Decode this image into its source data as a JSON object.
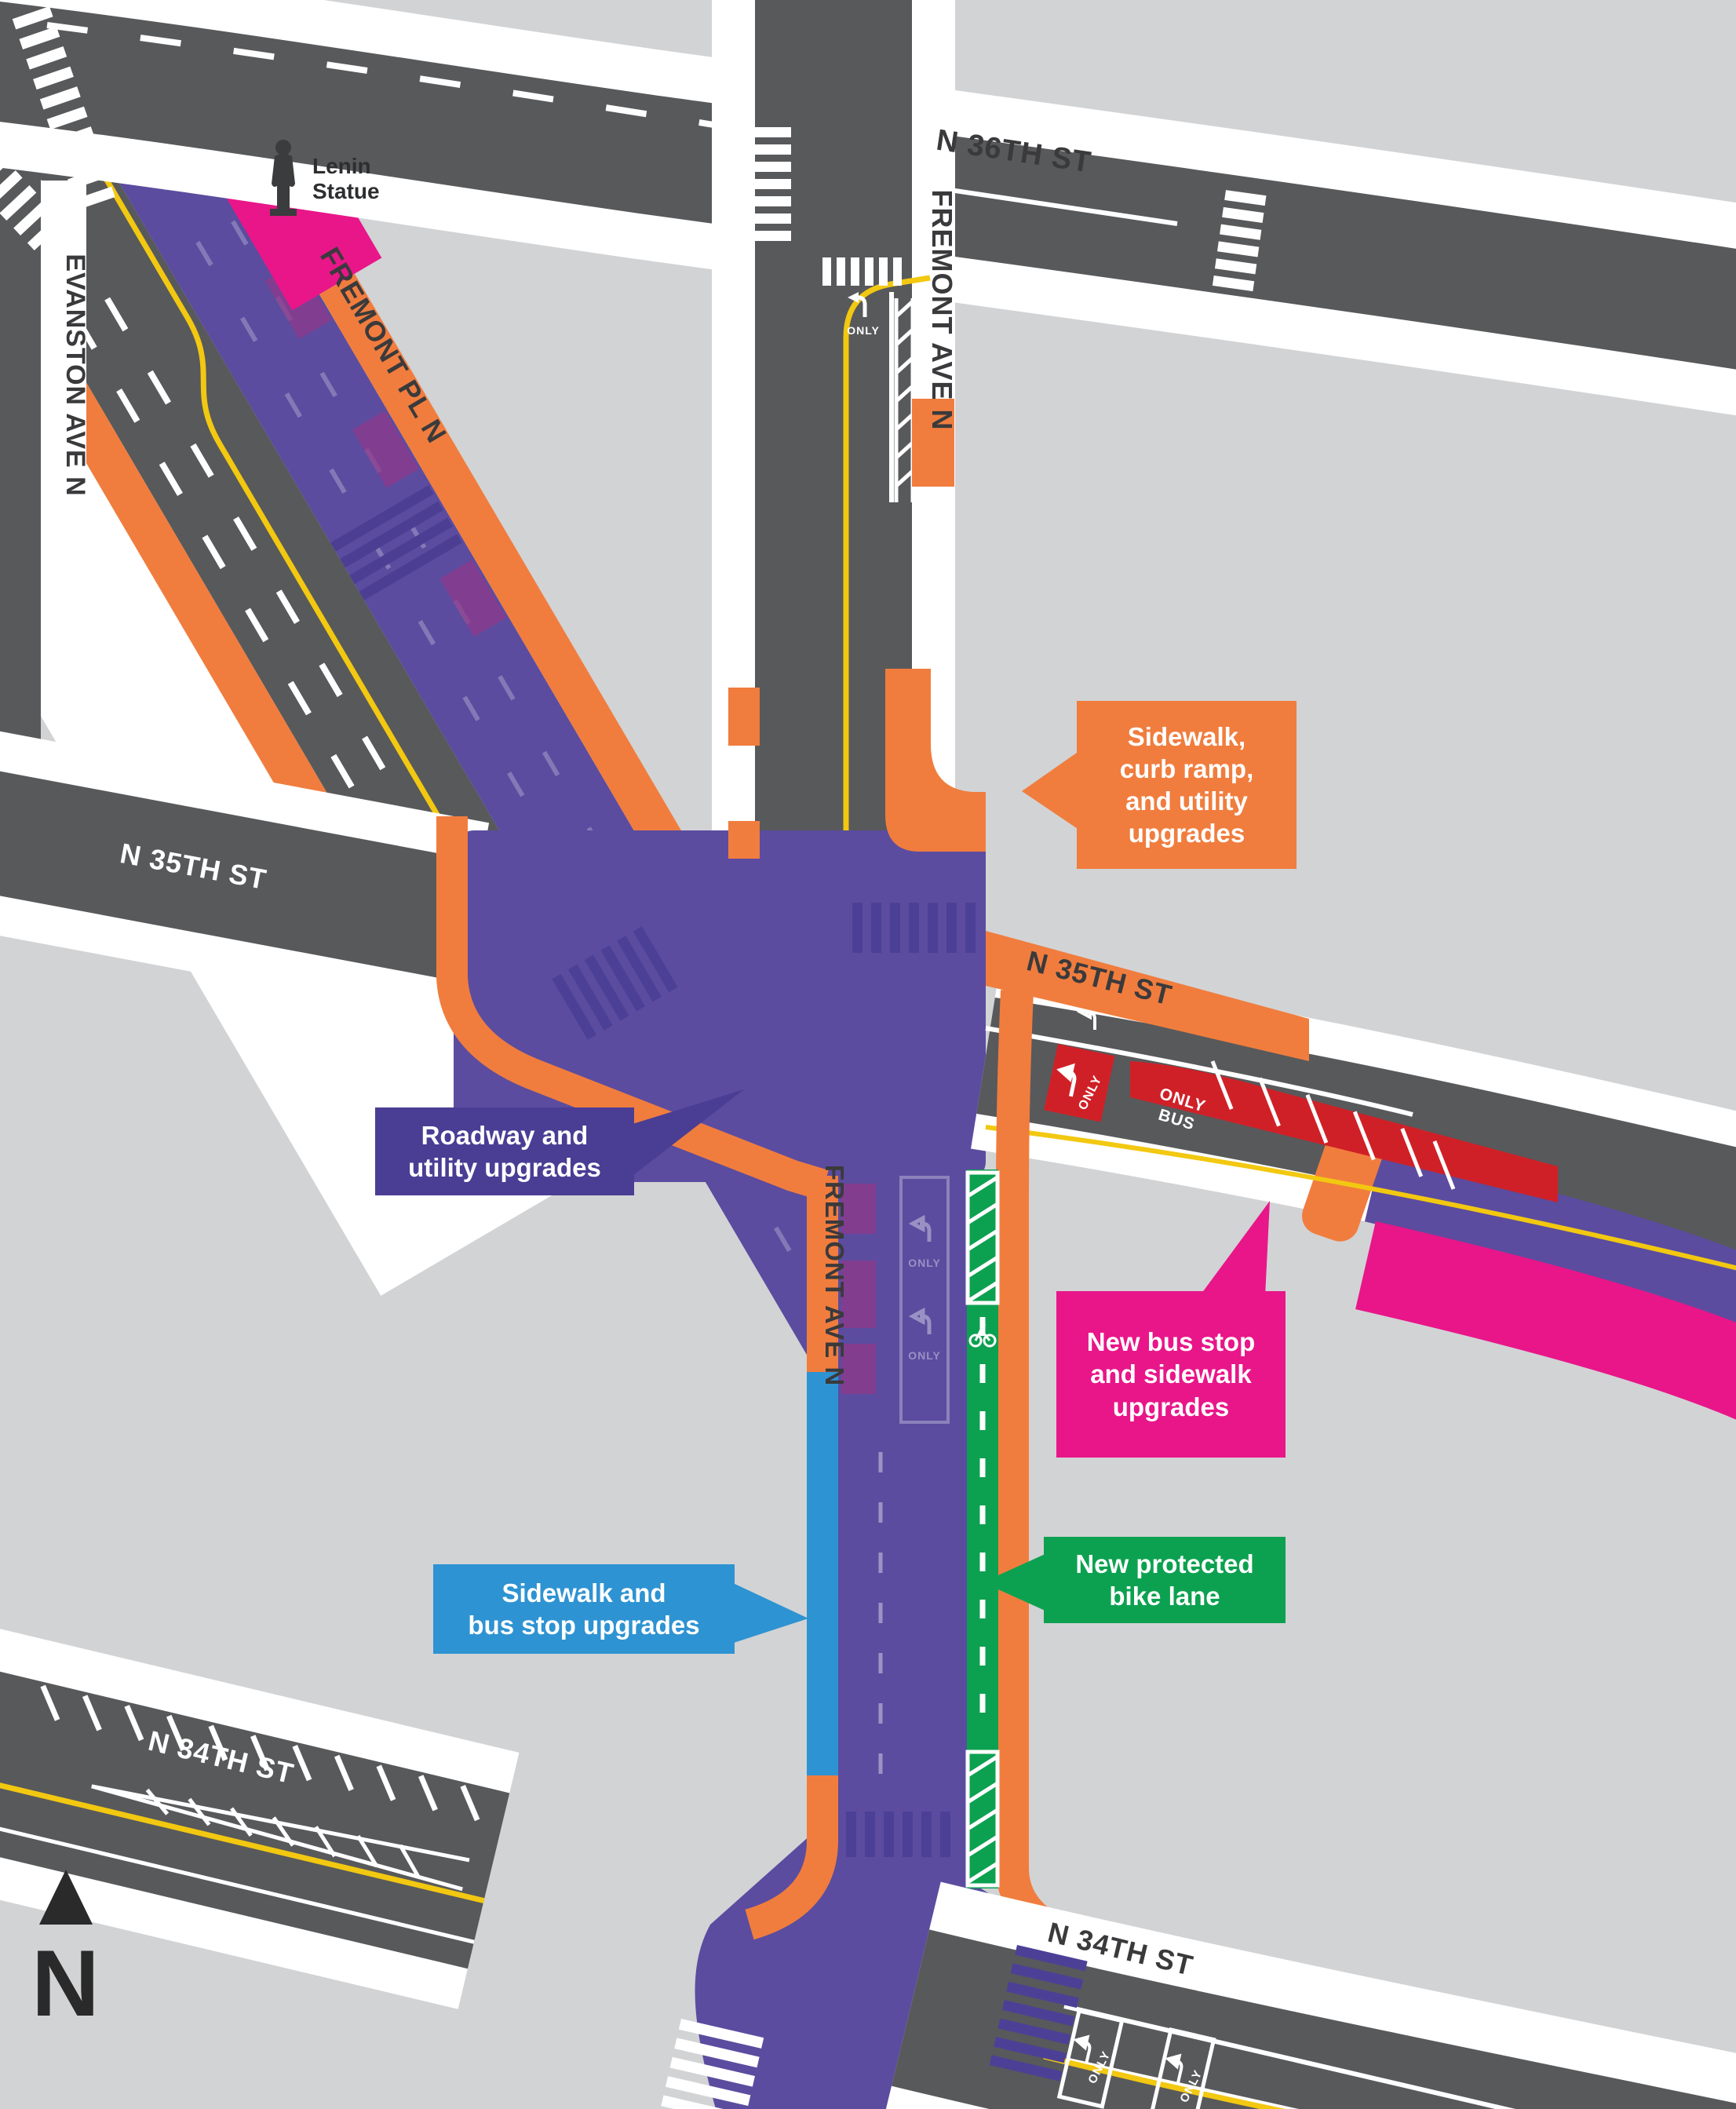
{
  "map": {
    "title": "Fremont paving and multimodal improvements map",
    "street_labels": {
      "n36th": "N 36TH ST",
      "fremont_ave_north": "FREMONT AVE N",
      "fremont_pl": "FREMONT PL N",
      "evanston": "EVANSTON AVE N",
      "n35th_west": "N 35TH ST",
      "n35th_east": "N 35TH ST",
      "fremont_ave_south": "FREMONT AVE N",
      "n34th_west": "N 34TH ST",
      "n34th_east": "N 34TH ST"
    },
    "poi": {
      "lenin_statue": "Lenin\nStatue"
    },
    "north_arrow": {
      "label": "N"
    },
    "road_markings": {
      "bus": "BUS",
      "only": "ONLY"
    },
    "callouts": [
      {
        "id": "sidewalk-curb-ramp-utility",
        "text": "Sidewalk,\ncurb ramp,\nand utility\nupgrades",
        "color": "#F07D3E"
      },
      {
        "id": "roadway-utility",
        "text": "Roadway and\nutility upgrades",
        "color": "#4A3D94"
      },
      {
        "id": "new-bus-stop-sidewalk",
        "text": "New bus stop\nand sidewalk\nupgrades",
        "color": "#E81689"
      },
      {
        "id": "sidewalk-bus-stop",
        "text": "Sidewalk and\nbus stop upgrades",
        "color": "#2E93D2"
      },
      {
        "id": "new-protected-bike-lane",
        "text": "New protected\nbike lane",
        "color": "#0CA150"
      }
    ],
    "colors": {
      "background_block": "#d2d3d5",
      "road": "#58595b",
      "roadway_upgrade_purple": "#5b4c9f",
      "sidewalk_upgrade_orange": "#F07D3E",
      "bus_stop_pink": "#E81689",
      "bus_stop_blue": "#2E93D2",
      "bike_lane_green": "#0CA150",
      "bus_lane_red": "#d02027",
      "centerline_yellow": "#f2c811"
    }
  }
}
